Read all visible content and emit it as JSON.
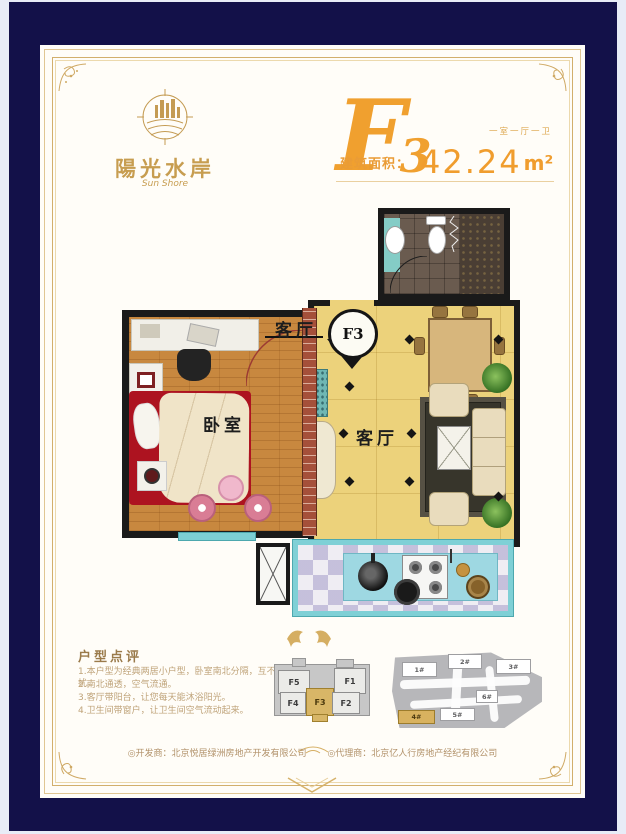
{
  "page": {
    "bg": "#e8ecf7",
    "border_color": "#131149",
    "paper_color": "#fffdf8",
    "gold": "#d2af6c",
    "accent": "#f09d2e"
  },
  "brand": {
    "name_cn": "陽光水岸",
    "name_en": "Sun Shore"
  },
  "title": {
    "unit_letter": "F",
    "unit_number": "3",
    "layout": "一室一厅一卫",
    "area_label": "建筑面积：",
    "area_value": "42.24",
    "area_unit": "m²"
  },
  "plan": {
    "bedroom_label": "卧室",
    "living_label": "客厅",
    "living_label_top": "客厅",
    "entry_label": "F3"
  },
  "review": {
    "title": "户型点评",
    "items": [
      "1.本户型为经典两居小户型，卧室南北分隔，互不干扰。",
      "2.南北通透，空气流通。",
      "3.客厅带阳台，让您每天能沐浴阳光。",
      "4.卫生间带窗户，让卫生间空气流动起来。"
    ]
  },
  "floorplate": {
    "units": [
      {
        "label": "F5",
        "highlight": false
      },
      {
        "label": "F1",
        "highlight": false
      },
      {
        "label": "F4",
        "highlight": false
      },
      {
        "label": "F3",
        "highlight": true
      },
      {
        "label": "F2",
        "highlight": false
      }
    ]
  },
  "siteplan": {
    "buildings": [
      {
        "label": "1#",
        "highlight": false
      },
      {
        "label": "2#",
        "highlight": false
      },
      {
        "label": "3#",
        "highlight": false
      },
      {
        "label": "6#",
        "highlight": false
      },
      {
        "label": "5#",
        "highlight": false
      },
      {
        "label": "4#",
        "highlight": true
      }
    ]
  },
  "footer": {
    "developer": "◎开发商：北京悦居绿洲房地产开发有限公司",
    "agent": "◎代理商：北京亿人行房地产经纪有限公司"
  }
}
